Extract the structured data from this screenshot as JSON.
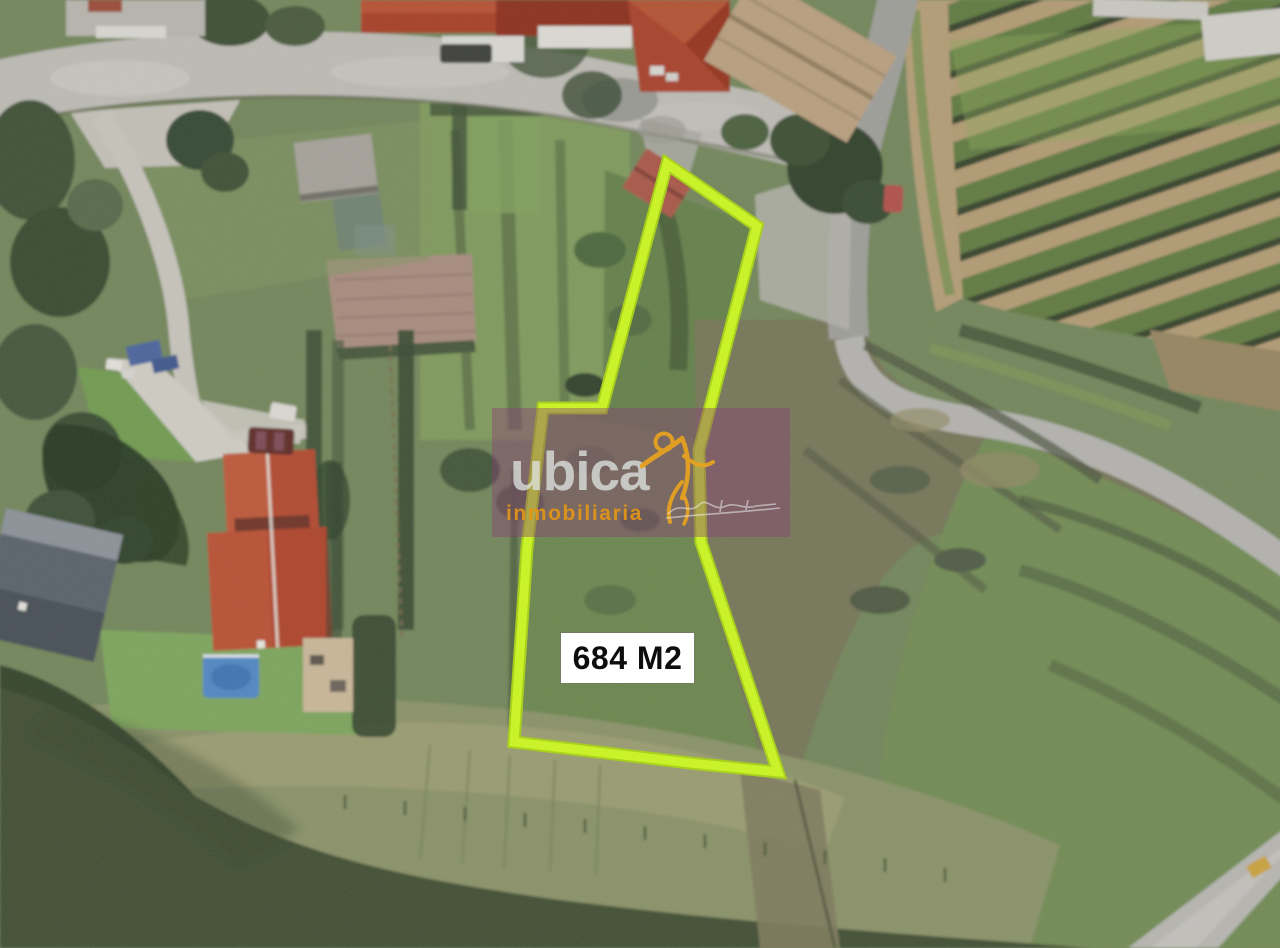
{
  "image": {
    "kind": "aerial satellite photo of rural land parcel with highlighted plot",
    "plot": {
      "area_label": "684 M2",
      "outline_color": "#c3f12b",
      "label_bg": "#ffffff",
      "label_text_color": "#0d0d0d"
    },
    "watermark": {
      "brand": "ubica",
      "tagline": "inmobiliaria",
      "brand_color": "#bcc2bf",
      "tagline_color": "#e89713",
      "logo_color": "#e9a41f",
      "logo_icon": "leaping-person-icon",
      "overlay_color": "rgba(138,62,118,0.42)"
    }
  }
}
